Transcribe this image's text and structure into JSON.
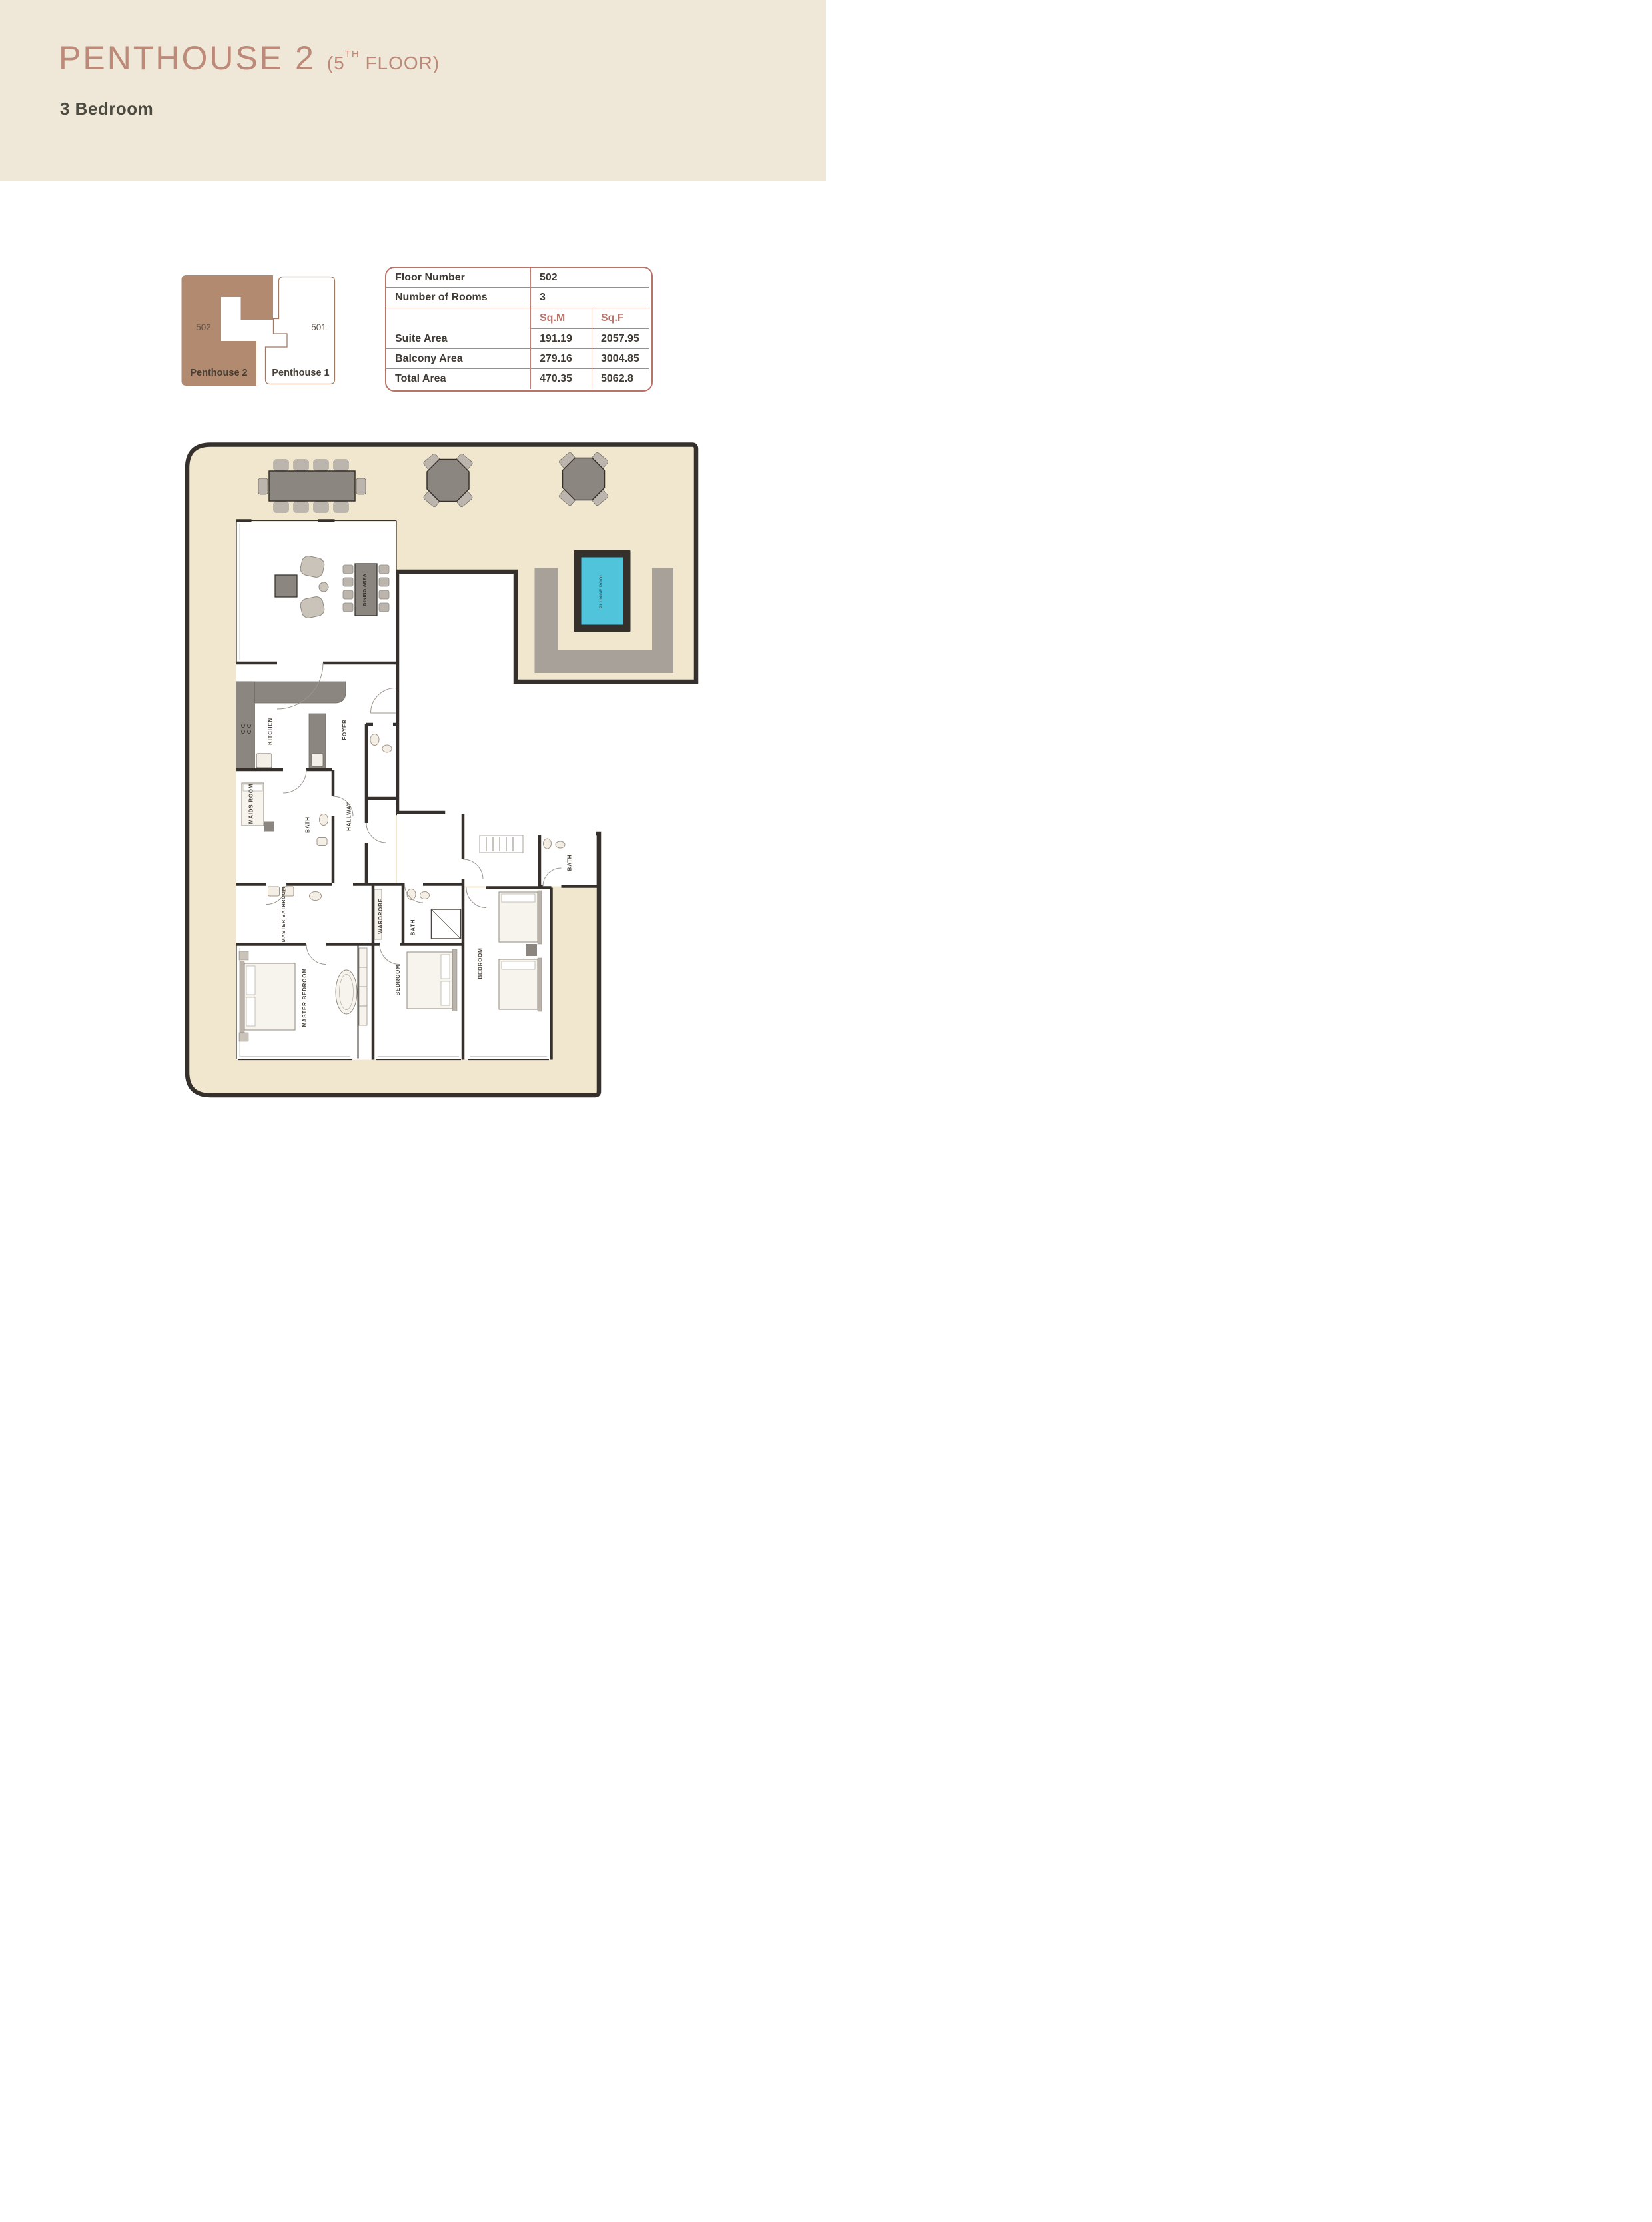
{
  "header": {
    "title": "PENTHOUSE 2",
    "floor_prefix": "(5",
    "floor_sup": "TH",
    "floor_suffix": " FLOOR)",
    "subtitle": "3 Bedroom"
  },
  "key_plan": {
    "unit2": {
      "number": "502",
      "name": "Penthouse 2"
    },
    "unit1": {
      "number": "501",
      "name": "Penthouse 1"
    }
  },
  "info_table": {
    "rows": [
      {
        "label": "Floor Number",
        "value": "502"
      },
      {
        "label": "Number of Rooms",
        "value": "3"
      }
    ],
    "area_header": {
      "sqm": "Sq.M",
      "sqf": "Sq.F"
    },
    "area_rows": [
      {
        "label": "Suite Area",
        "sqm": "191.19",
        "sqf": "2057.95"
      },
      {
        "label": "Balcony Area",
        "sqm": "279.16",
        "sqf": "3004.85"
      },
      {
        "label": "Total Area",
        "sqm": "470.35",
        "sqf": "5062.8"
      }
    ]
  },
  "floor_plan": {
    "labels": {
      "dining_area": "DINING AREA",
      "kitchen": "KITCHEN",
      "foyer": "FOYER",
      "hallway": "HALLWAY",
      "maids_room": "MAIDS ROOM",
      "bath_maid": "BATH",
      "master_bathroom": "MASTER BATHROOM",
      "master_bedroom": "MASTER BEDROOM",
      "wardrobe": "WARDROBE",
      "bath_mid": "BATH",
      "bedroom_mid": "BEDROOM",
      "bedroom_right": "BEDROOM",
      "bath_right": "BATH",
      "plunge_pool": "PLUNGE POOL"
    },
    "colors": {
      "terrace_beige": "#F0E7CE",
      "wall_dark": "#35302B",
      "pool_cyan": "#4FC4DB",
      "deck_gray": "#A8A199",
      "furniture_gray": "#8B8680",
      "keyplan_brown": "#B28A70",
      "accent_rose": "#BA746B",
      "band_cream": "#EFE8D8",
      "title_rose": "#BD8A7A"
    }
  }
}
